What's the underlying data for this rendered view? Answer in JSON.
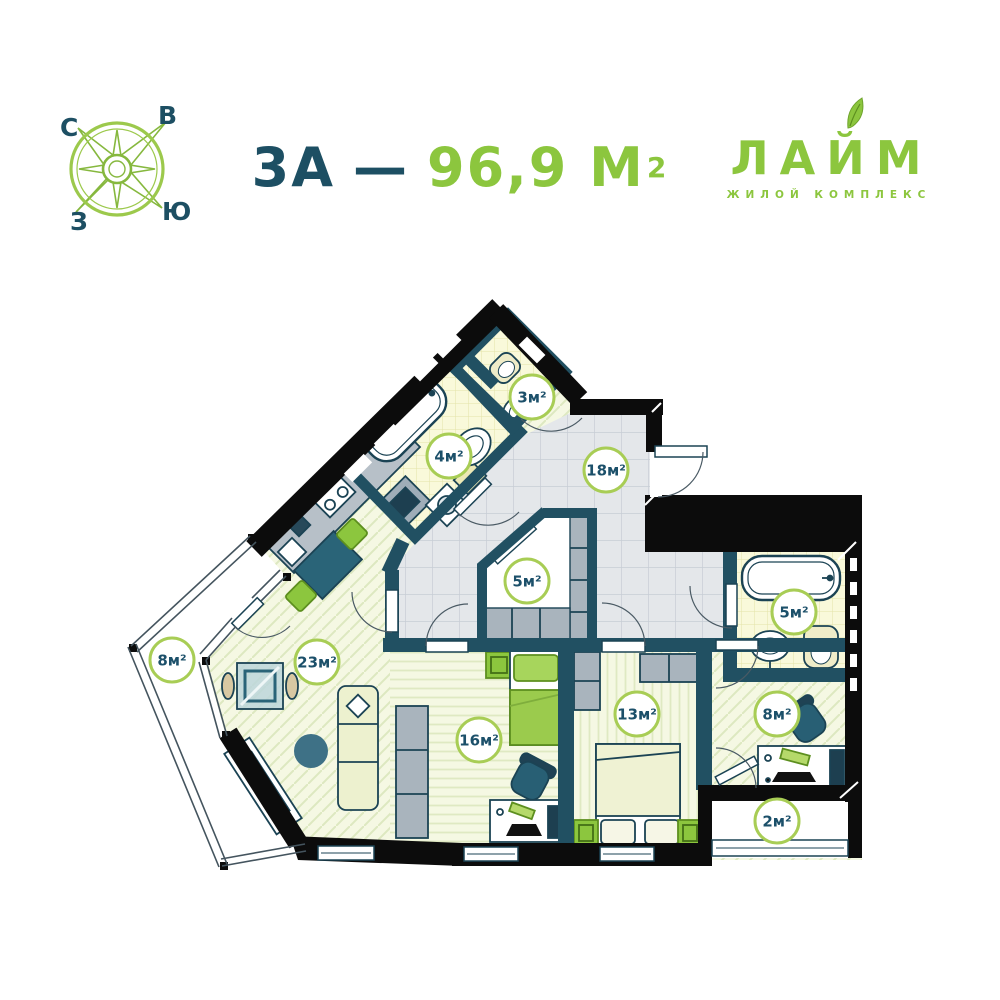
{
  "header": {
    "compass": {
      "letters": {
        "north": "С",
        "east": "В",
        "west": "З",
        "south": "Ю"
      }
    },
    "title": {
      "plan_label": "3А",
      "separator": "—",
      "area_value": "96,9 М",
      "area_sup": "2"
    },
    "logo": {
      "name": "ЛАЙМ",
      "tagline": "ЖИЛОЙ КОМПЛЕКС"
    }
  },
  "plan": {
    "rooms": [
      {
        "name": "toilet",
        "label": "3м²"
      },
      {
        "name": "bathroom-small",
        "label": "4м²"
      },
      {
        "name": "hallway",
        "label": "18м²"
      },
      {
        "name": "wardrobe",
        "label": "5м²"
      },
      {
        "name": "living-room",
        "label": "23м²"
      },
      {
        "name": "balcony-left",
        "label": "8м²"
      },
      {
        "name": "bedroom-large",
        "label": "16м²"
      },
      {
        "name": "bedroom-small",
        "label": "13м²"
      },
      {
        "name": "bathroom-main",
        "label": "5м²"
      },
      {
        "name": "office",
        "label": "8м²"
      },
      {
        "name": "balcony-right",
        "label": "2м²"
      }
    ],
    "colors": {
      "accent_green": "#8cc63e",
      "dark_teal": "#1d4f63",
      "wall_black": "#0c0c0c",
      "wall_teal": "#215062",
      "label_border": "#a8cd55"
    }
  }
}
